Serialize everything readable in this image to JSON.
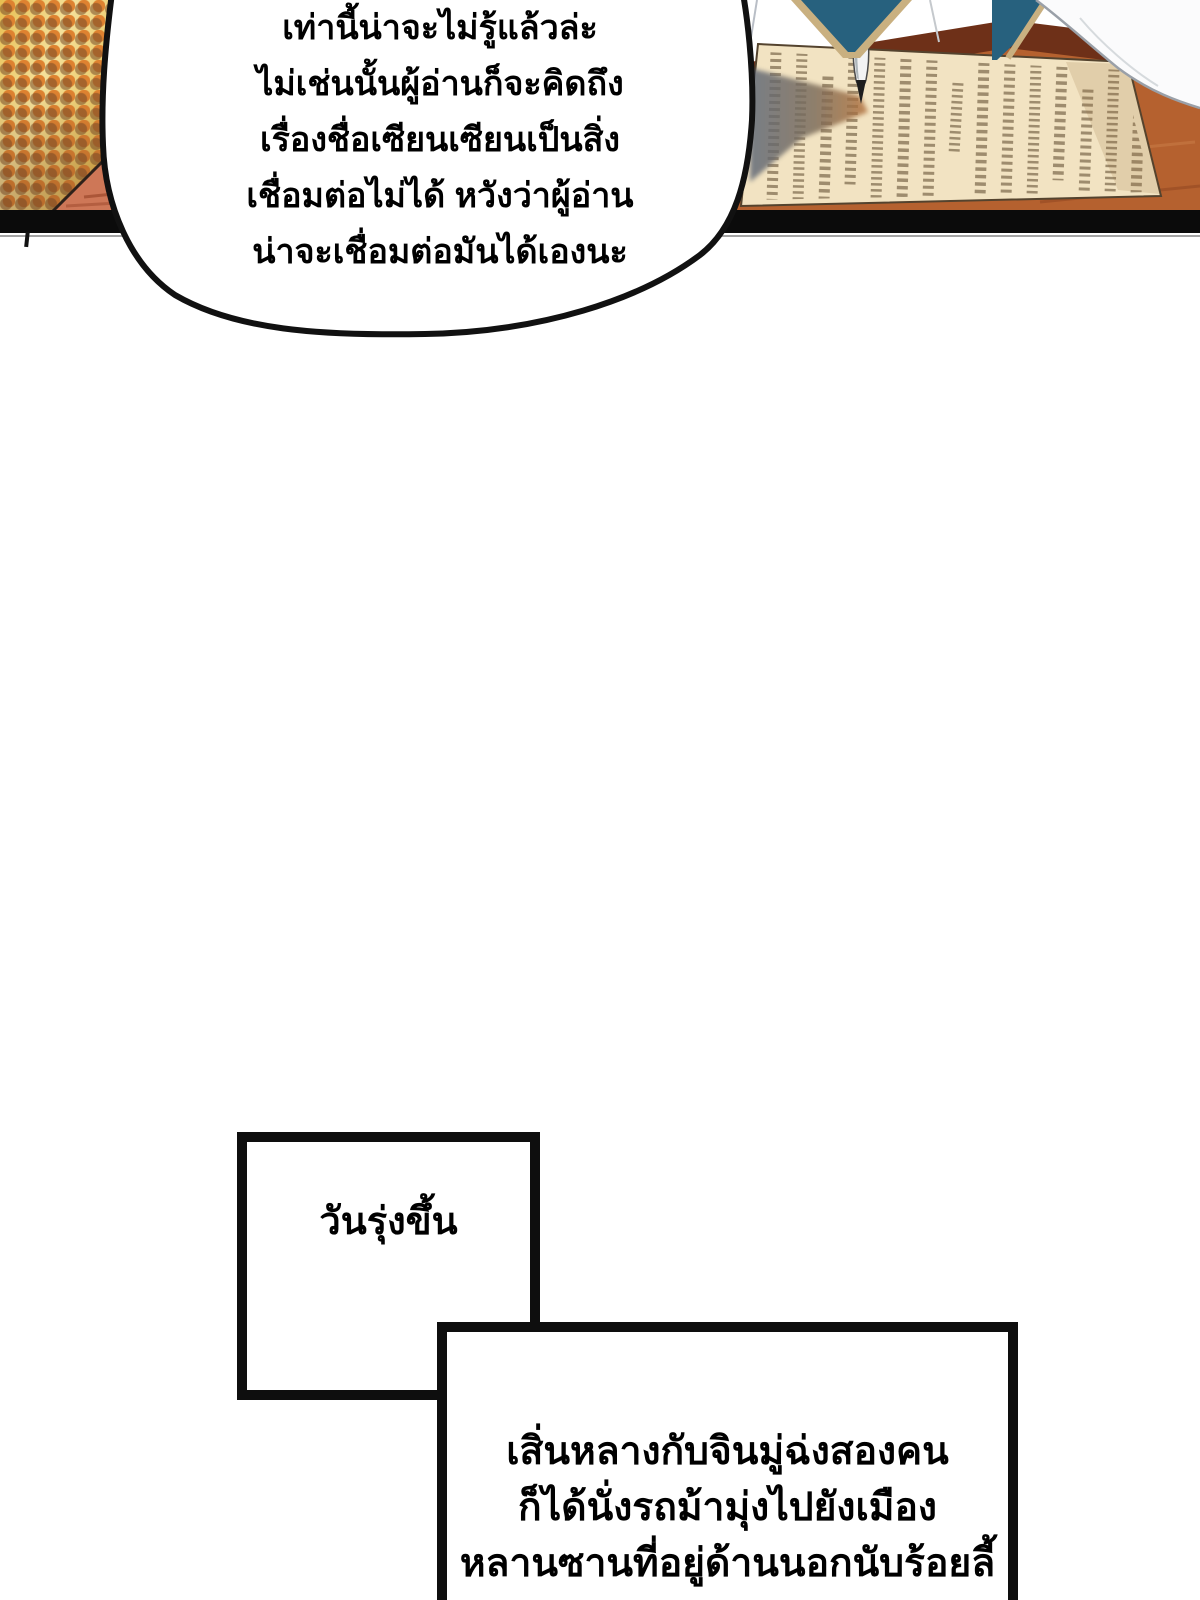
{
  "comic": {
    "speech_bubble": {
      "lines": [
        "เท่านี้น่าจะไม่รู้แล้วล่ะ",
        "ไม่เช่นนั้นผู้อ่านก็จะคิดถึง",
        "เรื่องชื่อเซียนเซียนเป็นสิ่ง",
        "เชื่อมต่อไม่ได้ หวังว่าผู้อ่าน",
        "น่าจะเชื่อมต่อมันได้เองนะ"
      ]
    },
    "caption_box_1": {
      "text": "วันรุ่งขึ้น"
    },
    "caption_box_2": {
      "lines": [
        "เสิ่นหลางกับจินมู่ฉ่งสองคน",
        "ก็ได้นั่งรถม้ามุ่งไปยังเมือง",
        "หลานซานที่อยู่ด้านนอกนับร้อยลี้"
      ]
    }
  },
  "colors": {
    "text": "#000000",
    "halftone_bg": "#EDC85F",
    "halftone_dot": "#DE8230",
    "halftone_dot_shadow": "#8A5A35",
    "desk_edge_dark": "#6E3018",
    "desk_surface": "#B5612F",
    "desk_streak": "#C87A45",
    "desk_triangle": "#CE7757",
    "paper": "#F2E3C2",
    "paper_outline": "#54432E",
    "scribble_ink": "#7D6B4E",
    "shadow_cool": "#5E6878",
    "shadow_warm": "#B5723C",
    "garment_blue": "#27617E",
    "garment_trim": "#C9B080",
    "sleeve_white": "#FBFBFC",
    "sleeve_shade": "#9AA0A8",
    "panel_bar": "#0B0B0B",
    "bubble_fill": "#FFFFFF",
    "bubble_stroke": "#111111"
  }
}
